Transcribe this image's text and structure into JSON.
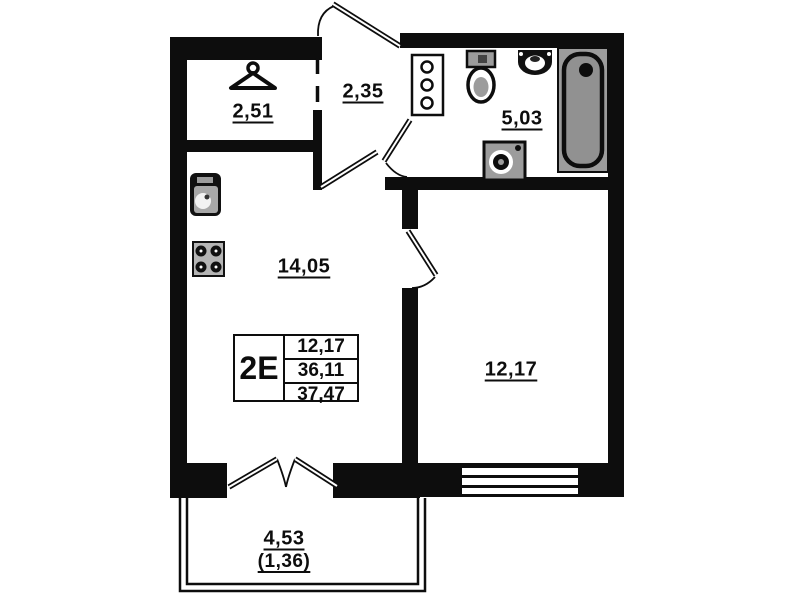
{
  "floor_plan": {
    "unit": {
      "type_label": "2E",
      "area_rows": [
        "12,17",
        "36,11",
        "37,47"
      ]
    },
    "rooms": {
      "wardrobe": {
        "area": "2,51"
      },
      "hallway": {
        "area": "2,35"
      },
      "bathroom": {
        "area": "5,03"
      },
      "kitchen_living": {
        "area": "14,05"
      },
      "bedroom": {
        "area": "12,17"
      },
      "balcony": {
        "area": "4,53",
        "area_reduced": "(1,36)"
      }
    },
    "colors": {
      "wall": "#0d0d0d",
      "fixture_gray": "#9c9c9c",
      "background": "#ffffff"
    },
    "icons": [
      "hanger-icon",
      "kitchen-sink-icon",
      "stove-icon",
      "shelf-icon",
      "toilet-icon",
      "sink-icon",
      "washing-machine-icon",
      "bathtub-icon"
    ]
  }
}
